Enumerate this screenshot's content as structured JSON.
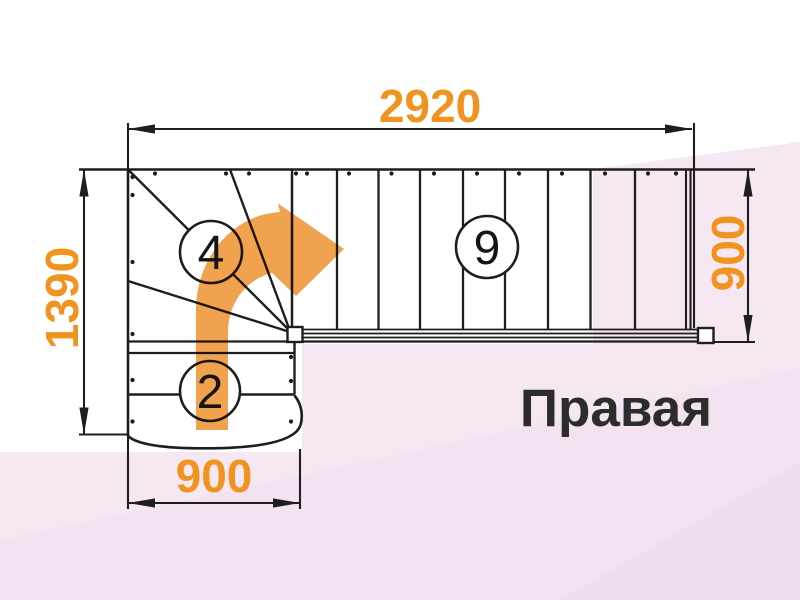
{
  "diagram": {
    "type": "staircase-plan",
    "title": "Правая",
    "dimensions": {
      "total_length": "2920",
      "total_depth": "1390",
      "flight_width_right": "900",
      "lower_flight_width": "900"
    },
    "step_counts": {
      "upper_straight_flight": "9",
      "winder_steps": "4",
      "lower_steps": "2"
    },
    "arrow": {
      "name": "walk-line-turn-right-arrow",
      "color": "#f0a24f"
    },
    "colors": {
      "dimension_text": "#f0941f",
      "linework": "#1e1e1e",
      "title_text": "#2c2c2c",
      "background_tint": "#f6e8f2"
    }
  }
}
